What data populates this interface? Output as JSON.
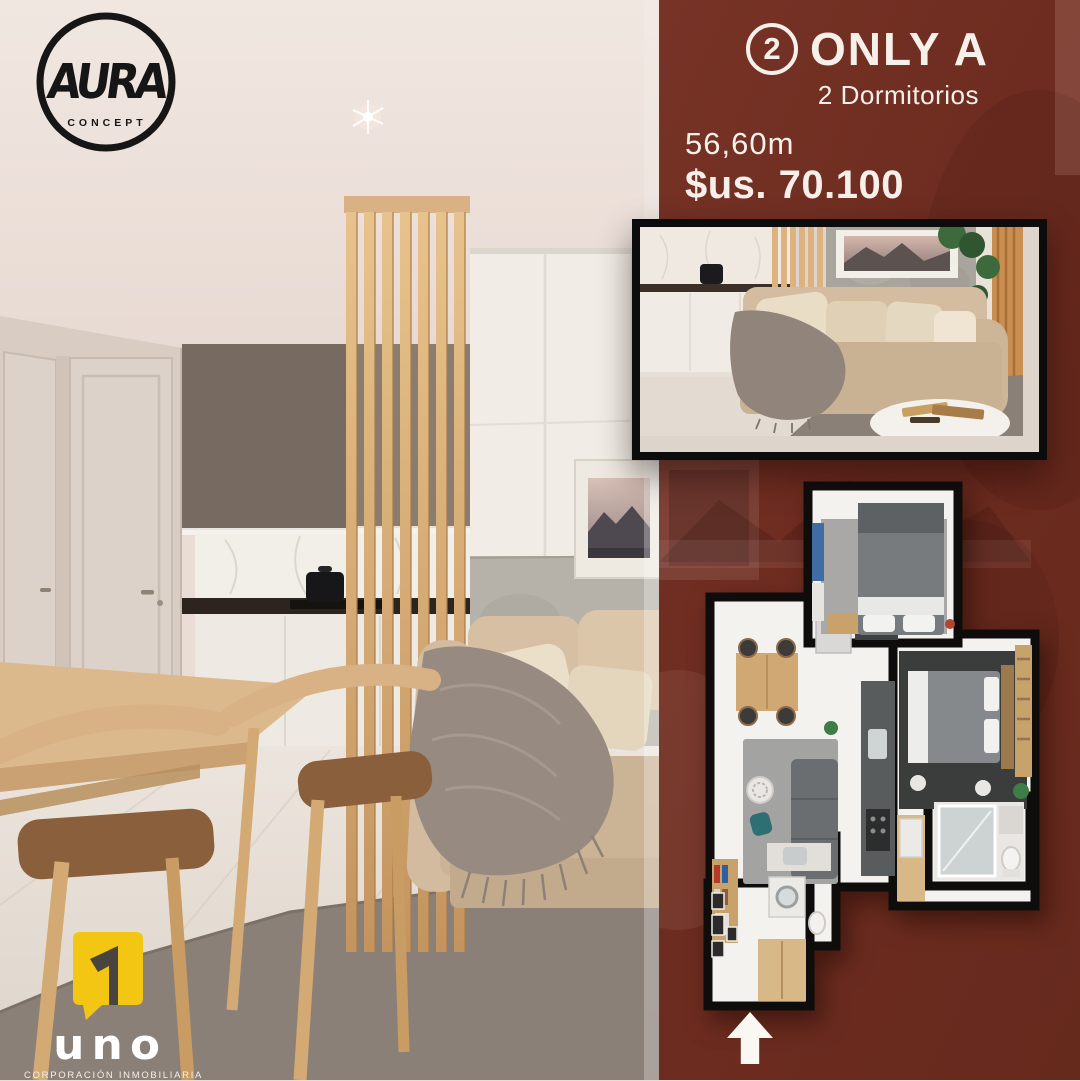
{
  "poster": {
    "brand": {
      "name": "AURA",
      "tagline": "CONCEPT"
    },
    "offer": {
      "badge_number": "2",
      "title": "ONLY A",
      "subtitle": "2 Dormitorios",
      "area": "56,60m",
      "price": "$us. 70.100"
    },
    "footer": {
      "name": "uno",
      "tagline": "CORPORACIÓN INMOBILIARIA"
    },
    "colors": {
      "panel_red": "#6E2C20",
      "text_white": "#F7F0EA",
      "brand_black": "#161616",
      "uno_yellow": "#F4C614"
    }
  }
}
